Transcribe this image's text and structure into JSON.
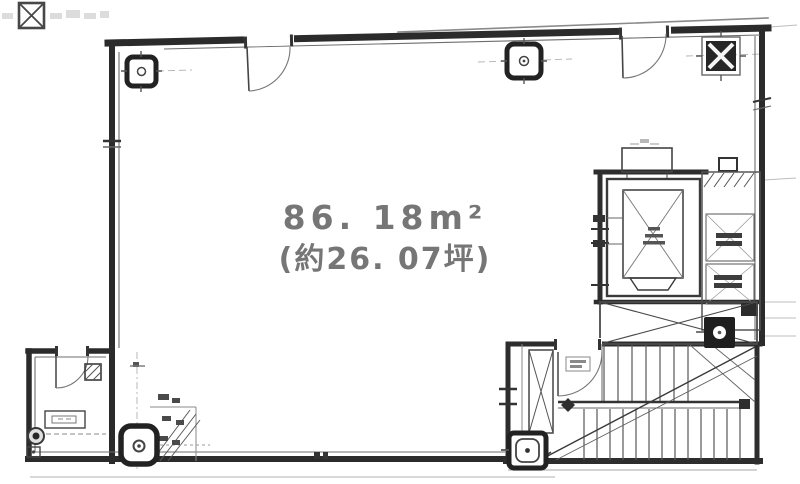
{
  "floorplan": {
    "area_sqm": "86. 18m²",
    "area_tsubo": "(約26. 07坪)",
    "colors": {
      "ink": "#2f2f2f",
      "ink_medium": "#555555",
      "ink_light": "#999999",
      "faint": "#c9c9c9",
      "label_text": "#767676",
      "background": "#ffffff"
    }
  }
}
